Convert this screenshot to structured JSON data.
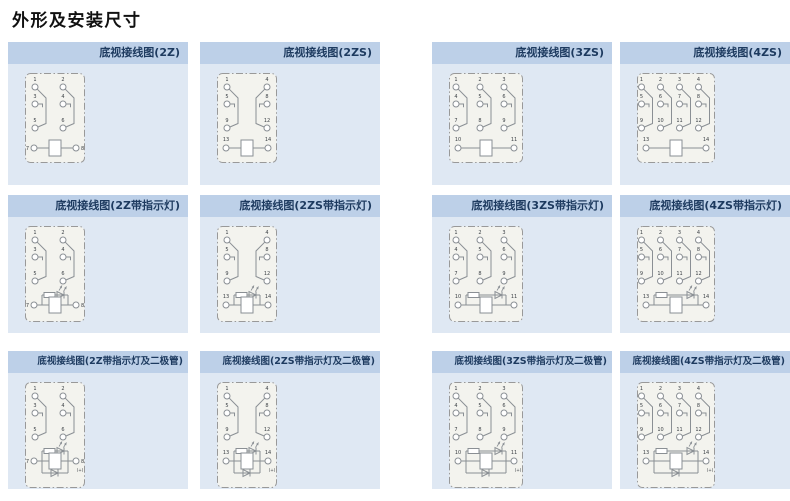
{
  "page": {
    "title": "外形及安装尺寸"
  },
  "colors": {
    "page_bg": "#ffffff",
    "title_text": "#111111",
    "header_bg": "#bdd0e8",
    "header_text": "#1d3a5f",
    "body_bg": "#dfe8f3",
    "box_bg": "#f3f3ee",
    "box_border": "#999999",
    "line": "#8a8f94",
    "pin_text": "#3c4146"
  },
  "panels": [
    {
      "id": "2z",
      "title": "底视接线图(2Z)",
      "variant": "plain",
      "contact_rows": [
        [
          "1",
          "2"
        ],
        [
          "3",
          "4"
        ],
        [
          "5",
          "6"
        ]
      ],
      "mirror": [
        false,
        false
      ],
      "coil_pins": [
        "7",
        "8"
      ],
      "coil_label_pos": "side"
    },
    {
      "id": "2zs",
      "title": "底视接线图(2ZS)",
      "variant": "plain",
      "contact_rows": [
        [
          "1",
          "4"
        ],
        [
          "5",
          "8"
        ],
        [
          "9",
          "12"
        ]
      ],
      "mirror": [
        false,
        true
      ],
      "coil_pins": [
        "13",
        "14"
      ],
      "coil_label_pos": "above"
    },
    {
      "id": "3zs",
      "title": "底视接线图(3ZS)",
      "variant": "plain",
      "contact_rows": [
        [
          "1",
          "2",
          "3"
        ],
        [
          "4",
          "5",
          "6"
        ],
        [
          "7",
          "8",
          "9"
        ]
      ],
      "mirror": [
        false,
        false,
        false
      ],
      "coil_pins": [
        "10",
        "11"
      ],
      "coil_label_pos": "above"
    },
    {
      "id": "4zs",
      "title": "底视接线图(4ZS)",
      "variant": "plain",
      "contact_rows": [
        [
          "1",
          "2",
          "3",
          "4"
        ],
        [
          "5",
          "6",
          "7",
          "8"
        ],
        [
          "9",
          "10",
          "11",
          "12"
        ]
      ],
      "mirror": [
        false,
        false,
        false,
        false
      ],
      "coil_pins": [
        "13",
        "14"
      ],
      "coil_label_pos": "above"
    },
    {
      "id": "2z-ind",
      "title": "底视接线图(2Z带指示灯)",
      "variant": "lamp",
      "contact_rows": [
        [
          "1",
          "2"
        ],
        [
          "3",
          "4"
        ],
        [
          "5",
          "6"
        ]
      ],
      "mirror": [
        false,
        false
      ],
      "coil_pins": [
        "7",
        "8"
      ],
      "coil_label_pos": "side"
    },
    {
      "id": "2zs-ind",
      "title": "底视接线图(2ZS带指示灯)",
      "variant": "lamp",
      "contact_rows": [
        [
          "1",
          "4"
        ],
        [
          "5",
          "8"
        ],
        [
          "9",
          "12"
        ]
      ],
      "mirror": [
        false,
        true
      ],
      "coil_pins": [
        "13",
        "14"
      ],
      "coil_label_pos": "above"
    },
    {
      "id": "3zs-ind",
      "title": "底视接线图(3ZS带指示灯)",
      "variant": "lamp",
      "contact_rows": [
        [
          "1",
          "2",
          "3"
        ],
        [
          "4",
          "5",
          "6"
        ],
        [
          "7",
          "8",
          "9"
        ]
      ],
      "mirror": [
        false,
        false,
        false
      ],
      "coil_pins": [
        "10",
        "11"
      ],
      "coil_label_pos": "above"
    },
    {
      "id": "4zs-ind",
      "title": "底视接线图(4ZS带指示灯)",
      "variant": "lamp",
      "contact_rows": [
        [
          "1",
          "2",
          "3",
          "4"
        ],
        [
          "5",
          "6",
          "7",
          "8"
        ],
        [
          "9",
          "10",
          "11",
          "12"
        ]
      ],
      "mirror": [
        false,
        false,
        false,
        false
      ],
      "coil_pins": [
        "13",
        "14"
      ],
      "coil_label_pos": "above"
    },
    {
      "id": "2z-ind-diode",
      "title": "底视接线图(2Z带指示灯及二极管)",
      "variant": "lamp_diode",
      "contact_rows": [
        [
          "1",
          "2"
        ],
        [
          "3",
          "4"
        ],
        [
          "5",
          "6"
        ]
      ],
      "mirror": [
        false,
        false
      ],
      "coil_pins": [
        "7",
        "8"
      ],
      "polarity_mark": "(+)",
      "coil_label_pos": "side"
    },
    {
      "id": "2zs-ind-diode",
      "title": "底视接线图(2ZS带指示灯及二极管)",
      "variant": "lamp_diode",
      "contact_rows": [
        [
          "1",
          "4"
        ],
        [
          "5",
          "8"
        ],
        [
          "9",
          "12"
        ]
      ],
      "mirror": [
        false,
        true
      ],
      "coil_pins": [
        "13",
        "14"
      ],
      "polarity_mark": "(+)",
      "coil_label_pos": "above"
    },
    {
      "id": "3zs-ind-diode",
      "title": "底视接线图(3ZS带指示灯及二极管)",
      "variant": "lamp_diode",
      "contact_rows": [
        [
          "1",
          "2",
          "3"
        ],
        [
          "4",
          "5",
          "6"
        ],
        [
          "7",
          "8",
          "9"
        ]
      ],
      "mirror": [
        false,
        false,
        false
      ],
      "coil_pins": [
        "10",
        "11"
      ],
      "polarity_mark": "(+)",
      "coil_label_pos": "above"
    },
    {
      "id": "4zs-ind-diode",
      "title": "底视接线图(4ZS带指示灯及二极管)",
      "variant": "lamp_diode",
      "contact_rows": [
        [
          "1",
          "2",
          "3",
          "4"
        ],
        [
          "5",
          "6",
          "7",
          "8"
        ],
        [
          "9",
          "10",
          "11",
          "12"
        ]
      ],
      "mirror": [
        false,
        false,
        false,
        false
      ],
      "coil_pins": [
        "13",
        "14"
      ],
      "polarity_mark": "(+)",
      "coil_label_pos": "above"
    }
  ]
}
